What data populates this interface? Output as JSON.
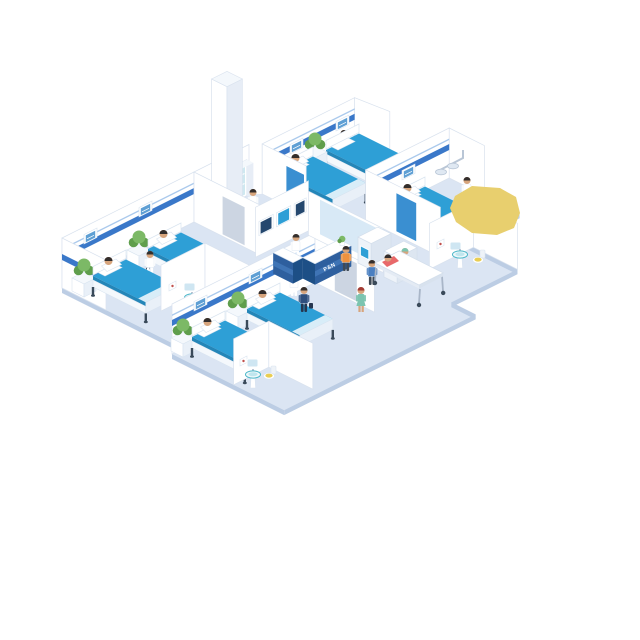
{
  "scene": {
    "type": "isometric-hospital-ward-illustration",
    "reception": {
      "sign_text": "P&N",
      "staff": "receptionist",
      "counter_color_name": "deskBlue"
    },
    "rooms": [
      {
        "name": "ward-room-left",
        "beds": 2,
        "patients": 2,
        "staff": [
          "nurse"
        ],
        "items": [
          "potted-plant",
          "potted-plant",
          "headboard-panel",
          "headboard-panel",
          "wall-stripe"
        ]
      },
      {
        "name": "ward-room-bottom",
        "beds": 2,
        "patients": 2,
        "staff": [
          "nurse"
        ],
        "items": [
          "potted-plant",
          "potted-plant",
          "headboard-panel",
          "headboard-panel",
          "wall-stripe"
        ]
      },
      {
        "name": "ward-room-top",
        "beds": 2,
        "patients": 1,
        "staff": [
          "nurse"
        ],
        "items": [
          "potted-plant",
          "headboard-panel",
          "headboard-panel",
          "wall-stripe",
          "blue-door"
        ]
      },
      {
        "name": "ward-room-right",
        "beds": 1,
        "patients": 1,
        "staff": [
          "doctor"
        ],
        "items": [
          "potted-plant",
          "headboard-panel",
          "exam-light",
          "blue-door",
          "wall-stripe"
        ]
      }
    ],
    "bathrooms": [
      {
        "name": "bathroom-left",
        "fixtures": [
          "pedestal-sink",
          "mirror",
          "toilet",
          "wall-art"
        ]
      },
      {
        "name": "bathroom-bottom",
        "fixtures": [
          "pedestal-sink",
          "mirror",
          "toilet",
          "wall-art"
        ]
      },
      {
        "name": "bathroom-right",
        "fixtures": [
          "pedestal-sink",
          "mirror",
          "toilet",
          "wall-art"
        ]
      }
    ],
    "corridor": {
      "fixtures": [
        "xray-monitor-wall",
        "medicine-cabinet",
        "tall-column",
        "glass-panel-wall",
        "gray-door",
        "gray-door"
      ],
      "kiosks": 2,
      "people": [
        "receptionist",
        "nurse-at-cabinet",
        "kiosk-user-orange",
        "kiosk-user-blue",
        "navy-visitor-with-briefcase",
        "nurse-green-walking",
        "surgeon-pushing-gurney",
        "gurney-patient"
      ]
    },
    "overlay": {
      "name": "yellow-blob",
      "shape": "irregular-polygon"
    }
  },
  "palette": {
    "floor": "#dbe5f3",
    "floorEdge": "#bccde4",
    "wall": "#ffffff",
    "wallShade": "#e7edf6",
    "wallLine": "#d9e2ee",
    "stripe": "#3a78c9",
    "stripeLight": "#aac9ec",
    "bedTop": "#2e9fd6",
    "bedSide": "#2486b8",
    "bedFootLight": "#d8edf8",
    "frame": "#f4f8fc",
    "frameLine": "#d9e4f0",
    "legDark": "#3a4a5a",
    "plantGreen": "#5f9e4c",
    "plantGreenLight": "#7cb966",
    "skin": "#d7a57d",
    "hairDark": "#332e2c",
    "hairRed": "#a33c35",
    "coatWhite": "#ffffff",
    "scrubGreen": "#7cc4b0",
    "navy": "#2f4f7d",
    "navyDark": "#26364f",
    "orange": "#ef923f",
    "blueShirt": "#4a7fc1",
    "slate": "#3f4a56",
    "jeans": "#3a6fb0",
    "red": "#e8696a",
    "deskBlue": "#2e5f9e",
    "deskBlueDark": "#1d4f86",
    "deskBand": "#3f74b5",
    "screenDark": "#24476e",
    "screenBright": "#2e9fd6",
    "panelBlue": "#5e9fd4",
    "glass": "#d8e9f6",
    "glassCab": "#cfe8f0",
    "door": "#ccd5e2",
    "doorBlue": "#3a8fd1",
    "teal": "#49b6c8",
    "tealLight": "#bfe6ee",
    "seatYellow": "#e9cd52",
    "blob": "#e8cf6e",
    "gray": "#a9b6c8",
    "lampGray": "#dfe8f2",
    "mirror": "#cfe6f2",
    "artRed": "#c0504d",
    "bg": "#ffffff"
  }
}
